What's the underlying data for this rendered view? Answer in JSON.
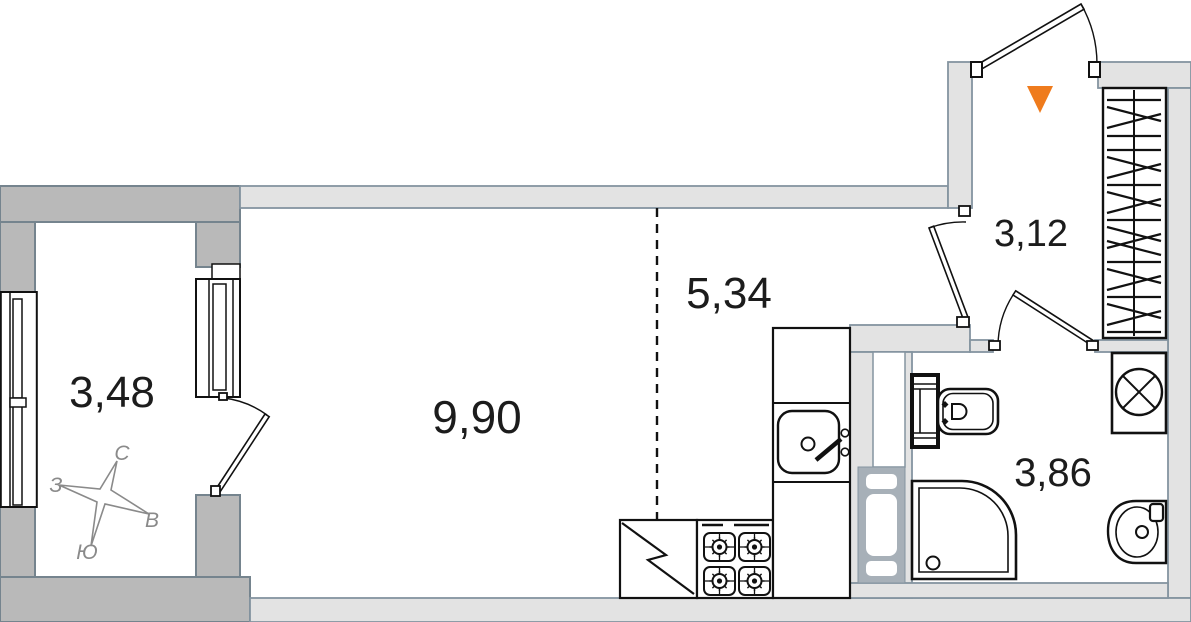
{
  "plan": {
    "type": "apartment-floor-plan"
  },
  "rooms": {
    "balcony": {
      "area": "3,48"
    },
    "living_room": {
      "area": "9,90"
    },
    "kitchen": {
      "area": "5,34"
    },
    "hallway": {
      "area": "3,12"
    },
    "bathroom": {
      "area": "3,86"
    }
  },
  "compass": {
    "north": "С",
    "south": "Ю",
    "west": "З",
    "east": "В"
  },
  "colors": {
    "entrance_arrow": "#EF7B1D",
    "balcony_wall": "#B9B9B9",
    "interior_wall": "#E3E3E3",
    "wall_outline": "#8494A0",
    "drawing_line": "#111111",
    "duct_fill": "#A7B0B8"
  },
  "fixtures": {
    "kitchen": [
      "fridge",
      "stove",
      "counter",
      "kitchen-sink"
    ],
    "bathroom": [
      "toilet",
      "shower",
      "washing-machine",
      "bathroom-sink",
      "vent-shaft"
    ],
    "hallway": [
      "wardrobe",
      "entrance-door",
      "entrance-arrow"
    ],
    "balcony": [
      "compass-rose",
      "balcony-window",
      "balcony-door"
    ]
  }
}
